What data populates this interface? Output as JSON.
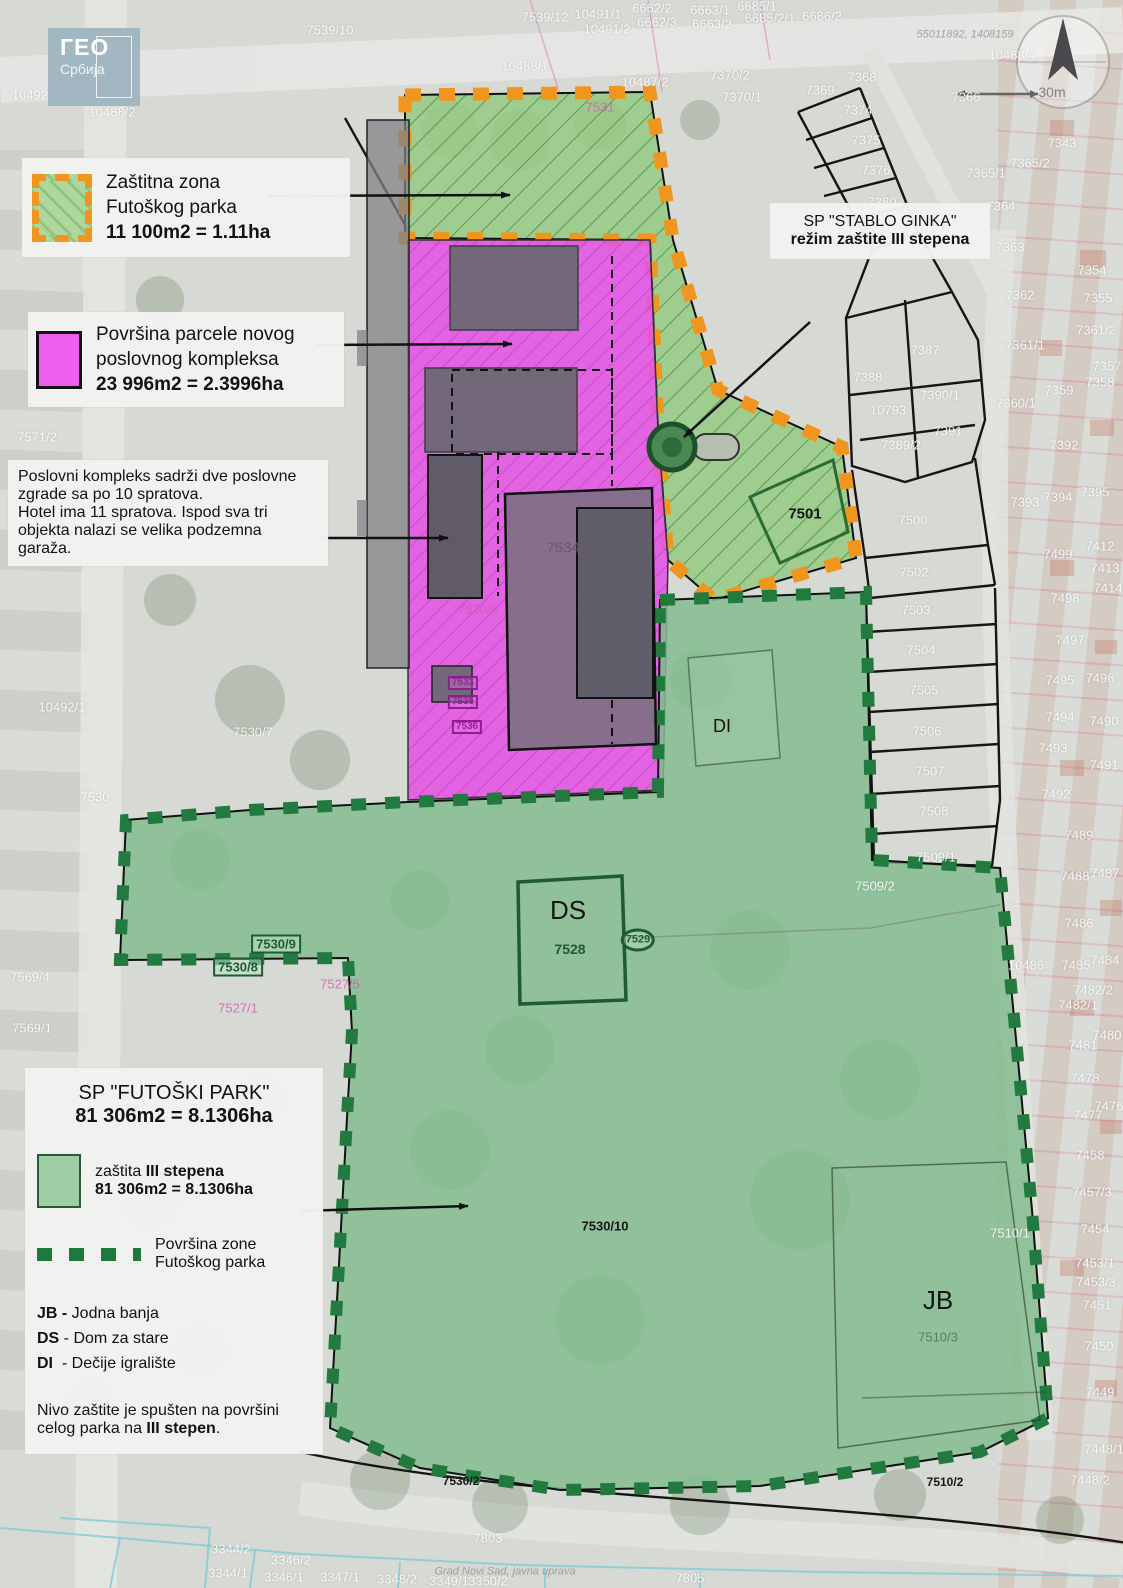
{
  "colors": {
    "orange_border": "#f0961e",
    "zone_green": "#95ca82",
    "park_green": "#84bc8f",
    "pink": "#e553e5",
    "park_border": "#227a3e",
    "building_gray": "#68686f"
  },
  "logo": {
    "line1": "ГЕО",
    "line2": "Србија"
  },
  "watermarks": {
    "top": "55011892, 1408159",
    "bottom": "Grad Novi Sad, javna uprava"
  },
  "compass": {
    "scale_label": "30m"
  },
  "callouts": {
    "zastitna": {
      "line1": "Zaštitna zona",
      "line2": "Futoškog parka",
      "area": "11 100m2 = 1.11ha"
    },
    "parcela": {
      "line1": "Površina parcele novog",
      "line2": "poslovnog kompleksa",
      "area": "23 996m2 = 2.3996ha"
    },
    "poslovni": {
      "p1": "Poslovni kompleks sadrži dve poslovne zgrade sa po 10 spratova.",
      "p2": "Hotel ima 11 spratova. Ispod sva tri objekta nalazi se velika podzemna garaža."
    },
    "stablo": {
      "title": "SP \"STABLO GINKA\"",
      "subtitle": "režim zaštite III stepena"
    },
    "futoski": {
      "title": "SP \"FUTOŠKI PARK\"",
      "area": "81 306m2 = 8.1306ha",
      "zastita_prefix": "zaštita ",
      "zastita_bold": "III stepena",
      "zastita_area": "81 306m2 = 8.1306ha",
      "zone_line1": "Površina zone",
      "zone_line2": "Futoškog parka",
      "abbreviations": [
        {
          "abbr": "JB",
          "name": "Jodna banja"
        },
        {
          "abbr": "DS",
          "name": "Dom za stare"
        },
        {
          "abbr": "DI",
          "name": "Dečije igralište"
        }
      ],
      "note_prefix": "Nivo zaštite je spušten na površini celog parka na ",
      "note_bold": "III stepen",
      "note_suffix": "."
    }
  },
  "map_labels": [
    {
      "t": "7539/10",
      "x": 330,
      "y": 30,
      "c": "w"
    },
    {
      "t": "10492",
      "x": 30,
      "y": 95,
      "c": "w"
    },
    {
      "t": "10488/2",
      "x": 112,
      "y": 112,
      "c": "w"
    },
    {
      "t": "7539/12",
      "x": 545,
      "y": 17,
      "c": "w"
    },
    {
      "t": "10491/1",
      "x": 598,
      "y": 14,
      "c": "w"
    },
    {
      "t": "10491/2",
      "x": 607,
      "y": 29,
      "c": "w"
    },
    {
      "t": "6662/2",
      "x": 652,
      "y": 8,
      "c": "w"
    },
    {
      "t": "6663/1",
      "x": 710,
      "y": 10,
      "c": "w"
    },
    {
      "t": "6662/3",
      "x": 657,
      "y": 22,
      "c": "w"
    },
    {
      "t": "6663/2",
      "x": 712,
      "y": 24,
      "c": "w"
    },
    {
      "t": "6685/1",
      "x": 757,
      "y": 6,
      "c": "w"
    },
    {
      "t": "6685/2/1",
      "x": 770,
      "y": 18,
      "c": "w"
    },
    {
      "t": "6686/2",
      "x": 822,
      "y": 16,
      "c": "w"
    },
    {
      "t": "10488/1",
      "x": 525,
      "y": 66,
      "c": "w"
    },
    {
      "t": "10487/2",
      "x": 645,
      "y": 82,
      "c": "w"
    },
    {
      "t": "7370/2",
      "x": 730,
      "y": 75,
      "c": "w"
    },
    {
      "t": "7370/1",
      "x": 742,
      "y": 97,
      "c": "w"
    },
    {
      "t": "10488/4",
      "x": 1012,
      "y": 55,
      "c": "w"
    },
    {
      "t": "7368",
      "x": 862,
      "y": 77,
      "c": "w"
    },
    {
      "t": "7369",
      "x": 820,
      "y": 90,
      "c": "w"
    },
    {
      "t": "7374",
      "x": 858,
      "y": 110,
      "c": "w"
    },
    {
      "t": "7375",
      "x": 866,
      "y": 140,
      "c": "w"
    },
    {
      "t": "7376",
      "x": 876,
      "y": 170,
      "c": "w"
    },
    {
      "t": "7380",
      "x": 882,
      "y": 202,
      "c": "w"
    },
    {
      "t": "7366",
      "x": 966,
      "y": 97,
      "c": "w"
    },
    {
      "t": "7343",
      "x": 1062,
      "y": 143,
      "c": "w"
    },
    {
      "t": "7365/2",
      "x": 1030,
      "y": 163,
      "c": "w"
    },
    {
      "t": "7365/1",
      "x": 986,
      "y": 173,
      "c": "w"
    },
    {
      "t": "7364",
      "x": 1001,
      "y": 206,
      "c": "w"
    },
    {
      "t": "7363",
      "x": 1010,
      "y": 247,
      "c": "w"
    },
    {
      "t": "7362",
      "x": 1020,
      "y": 295,
      "c": "w"
    },
    {
      "t": "7354",
      "x": 1092,
      "y": 270,
      "c": "w"
    },
    {
      "t": "7355",
      "x": 1098,
      "y": 298,
      "c": "w"
    },
    {
      "t": "7361/2",
      "x": 1096,
      "y": 330,
      "c": "w"
    },
    {
      "t": "7361/1",
      "x": 1025,
      "y": 345,
      "c": "w"
    },
    {
      "t": "7357",
      "x": 1107,
      "y": 366,
      "c": "w"
    },
    {
      "t": "7387",
      "x": 925,
      "y": 350,
      "c": "w"
    },
    {
      "t": "7388",
      "x": 868,
      "y": 377,
      "c": "w"
    },
    {
      "t": "7358",
      "x": 1100,
      "y": 382,
      "c": "w"
    },
    {
      "t": "7359",
      "x": 1059,
      "y": 390,
      "c": "w"
    },
    {
      "t": "7390/1",
      "x": 940,
      "y": 395,
      "c": "w"
    },
    {
      "t": "7360/1",
      "x": 1016,
      "y": 403,
      "c": "w"
    },
    {
      "t": "10793",
      "x": 888,
      "y": 410,
      "c": "w"
    },
    {
      "t": "7391",
      "x": 948,
      "y": 431,
      "c": "w"
    },
    {
      "t": "7389/2",
      "x": 901,
      "y": 445,
      "c": "w"
    },
    {
      "t": "7392",
      "x": 1064,
      "y": 445,
      "c": "w"
    },
    {
      "t": "7393",
      "x": 1025,
      "y": 502,
      "c": "w"
    },
    {
      "t": "7394",
      "x": 1058,
      "y": 497,
      "c": "w"
    },
    {
      "t": "7395",
      "x": 1095,
      "y": 492,
      "c": "w"
    },
    {
      "t": "7500",
      "x": 913,
      "y": 520,
      "c": "w"
    },
    {
      "t": "7412",
      "x": 1100,
      "y": 546,
      "c": "w"
    },
    {
      "t": "7499",
      "x": 1058,
      "y": 554,
      "c": "w"
    },
    {
      "t": "7502",
      "x": 914,
      "y": 572,
      "c": "w"
    },
    {
      "t": "7413",
      "x": 1105,
      "y": 568,
      "c": "w"
    },
    {
      "t": "7414",
      "x": 1108,
      "y": 588,
      "c": "w"
    },
    {
      "t": "7498",
      "x": 1065,
      "y": 598,
      "c": "w"
    },
    {
      "t": "7503",
      "x": 916,
      "y": 610,
      "c": "w"
    },
    {
      "t": "7497",
      "x": 1070,
      "y": 640,
      "c": "w"
    },
    {
      "t": "7504",
      "x": 921,
      "y": 650,
      "c": "w"
    },
    {
      "t": "7495",
      "x": 1060,
      "y": 680,
      "c": "w"
    },
    {
      "t": "7496",
      "x": 1100,
      "y": 678,
      "c": "w"
    },
    {
      "t": "7505",
      "x": 924,
      "y": 690,
      "c": "w"
    },
    {
      "t": "7494",
      "x": 1060,
      "y": 717,
      "c": "w"
    },
    {
      "t": "7490",
      "x": 1104,
      "y": 721,
      "c": "w"
    },
    {
      "t": "7506",
      "x": 927,
      "y": 731,
      "c": "w"
    },
    {
      "t": "7493",
      "x": 1053,
      "y": 748,
      "c": "w"
    },
    {
      "t": "7491",
      "x": 1104,
      "y": 765,
      "c": "w"
    },
    {
      "t": "7507",
      "x": 930,
      "y": 771,
      "c": "w"
    },
    {
      "t": "7492",
      "x": 1056,
      "y": 794,
      "c": "w"
    },
    {
      "t": "7508",
      "x": 934,
      "y": 811,
      "c": "w"
    },
    {
      "t": "7489",
      "x": 1079,
      "y": 835,
      "c": "w"
    },
    {
      "t": "7509/1",
      "x": 936,
      "y": 857,
      "c": "w"
    },
    {
      "t": "7488",
      "x": 1075,
      "y": 876,
      "c": "w"
    },
    {
      "t": "7487",
      "x": 1105,
      "y": 873,
      "c": "w"
    },
    {
      "t": "7509/2",
      "x": 875,
      "y": 886,
      "c": "w"
    },
    {
      "t": "7486",
      "x": 1079,
      "y": 923,
      "c": "w"
    },
    {
      "t": "10486",
      "x": 1026,
      "y": 965,
      "c": "w"
    },
    {
      "t": "7485",
      "x": 1076,
      "y": 965,
      "c": "w"
    },
    {
      "t": "7484",
      "x": 1105,
      "y": 960,
      "c": "w"
    },
    {
      "t": "7482/2",
      "x": 1093,
      "y": 990,
      "c": "w"
    },
    {
      "t": "7482/1",
      "x": 1078,
      "y": 1005,
      "c": "w"
    },
    {
      "t": "7480",
      "x": 1107,
      "y": 1035,
      "c": "w"
    },
    {
      "t": "7481",
      "x": 1083,
      "y": 1045,
      "c": "w"
    },
    {
      "t": "7478",
      "x": 1085,
      "y": 1078,
      "c": "w"
    },
    {
      "t": "7476",
      "x": 1109,
      "y": 1106,
      "c": "w"
    },
    {
      "t": "7477",
      "x": 1088,
      "y": 1115,
      "c": "w"
    },
    {
      "t": "7458",
      "x": 1090,
      "y": 1155,
      "c": "w"
    },
    {
      "t": "7457/3",
      "x": 1092,
      "y": 1192,
      "c": "w"
    },
    {
      "t": "7454",
      "x": 1095,
      "y": 1229,
      "c": "w"
    },
    {
      "t": "7510/1",
      "x": 1010,
      "y": 1233,
      "c": "w"
    },
    {
      "t": "7453/1",
      "x": 1095,
      "y": 1263,
      "c": "w"
    },
    {
      "t": "7453/3",
      "x": 1096,
      "y": 1282,
      "c": "w"
    },
    {
      "t": "7451",
      "x": 1097,
      "y": 1305,
      "c": "w"
    },
    {
      "t": "7450",
      "x": 1099,
      "y": 1346,
      "c": "w"
    },
    {
      "t": "7449",
      "x": 1100,
      "y": 1392,
      "c": "w"
    },
    {
      "t": "7448/1",
      "x": 1104,
      "y": 1449,
      "c": "w"
    },
    {
      "t": "7448/2",
      "x": 1090,
      "y": 1480,
      "c": "w"
    },
    {
      "t": "7571/2",
      "x": 37,
      "y": 437,
      "c": "w"
    },
    {
      "t": "10492/1",
      "x": 62,
      "y": 707,
      "c": "w"
    },
    {
      "t": "7530/7",
      "x": 253,
      "y": 732,
      "c": "w"
    },
    {
      "t": "7530",
      "x": 95,
      "y": 797,
      "c": "w"
    },
    {
      "t": "7569/4",
      "x": 30,
      "y": 977,
      "c": "w"
    },
    {
      "t": "7569/1",
      "x": 32,
      "y": 1028,
      "c": "w"
    },
    {
      "t": "7803",
      "x": 488,
      "y": 1538,
      "c": "w"
    },
    {
      "t": "7805",
      "x": 690,
      "y": 1578,
      "c": "w"
    },
    {
      "t": "3344/2",
      "x": 231,
      "y": 1549,
      "c": "w"
    },
    {
      "t": "3346/2",
      "x": 291,
      "y": 1560,
      "c": "w"
    },
    {
      "t": "3344/1",
      "x": 228,
      "y": 1573,
      "c": "w"
    },
    {
      "t": "3346/1",
      "x": 284,
      "y": 1577,
      "c": "w"
    },
    {
      "t": "3347/1",
      "x": 340,
      "y": 1577,
      "c": "w"
    },
    {
      "t": "3348/2",
      "x": 397,
      "y": 1579,
      "c": "w"
    },
    {
      "t": "3349/1",
      "x": 449,
      "y": 1581,
      "c": "w"
    },
    {
      "t": "3350/2",
      "x": 488,
      "y": 1581,
      "c": "w"
    },
    {
      "t": "7531",
      "x": 600,
      "y": 107,
      "c": "p"
    },
    {
      "t": "7527/1",
      "x": 238,
      "y": 1008,
      "c": "p"
    },
    {
      "t": "7527/5",
      "x": 340,
      "y": 984,
      "c": "p"
    },
    {
      "t": "7530/6",
      "x": 478,
      "y": 609,
      "c": "p"
    },
    {
      "t": "7528",
      "x": 570,
      "y": 949,
      "c": "g"
    },
    {
      "t": "7530/9",
      "x": 276,
      "y": 944,
      "c": "gb"
    },
    {
      "t": "7530/8",
      "x": 238,
      "y": 967,
      "c": "gb"
    },
    {
      "t": "7533",
      "x": 463,
      "y": 683,
      "c": "mb"
    },
    {
      "t": "7535",
      "x": 463,
      "y": 702,
      "c": "mb"
    },
    {
      "t": "7536",
      "x": 467,
      "y": 727,
      "c": "mb"
    },
    {
      "t": "7534",
      "x": 563,
      "y": 548,
      "c": "dg"
    },
    {
      "t": "7501",
      "x": 805,
      "y": 514,
      "c": "db",
      "s": 15
    },
    {
      "t": "DI",
      "x": 722,
      "y": 726,
      "c": "dl",
      "s": 18
    },
    {
      "t": "DS",
      "x": 568,
      "y": 910,
      "c": "dl",
      "s": 26
    },
    {
      "t": "JB",
      "x": 938,
      "y": 1300,
      "c": "dl",
      "s": 26
    },
    {
      "t": "7529",
      "x": 638,
      "y": 940,
      "c": "gc"
    },
    {
      "t": "7530/10",
      "x": 605,
      "y": 1226,
      "c": "db",
      "s": 13
    },
    {
      "t": "7530/2",
      "x": 461,
      "y": 1481,
      "c": "db",
      "s": 12
    },
    {
      "t": "7510/2",
      "x": 945,
      "y": 1482,
      "c": "db",
      "s": 12
    },
    {
      "t": "7510/3",
      "x": 938,
      "y": 1337,
      "c": "gy"
    }
  ]
}
